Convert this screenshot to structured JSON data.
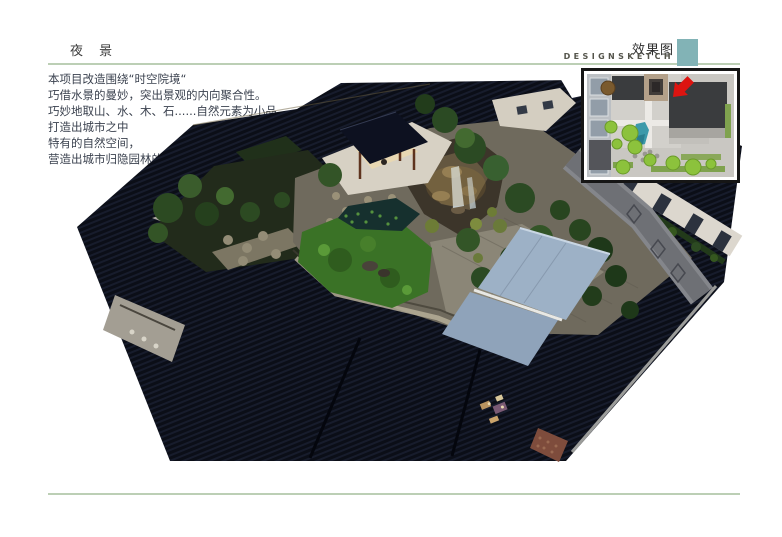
{
  "header": {
    "title": "夜 景",
    "right_title": "效果图",
    "right_subtitle": "DESIGNSKETCH"
  },
  "intro": {
    "lines": [
      "本项目改造围绕“时空院境“",
      "巧借水景的曼妙，突出景观的内向聚合性。",
      "巧妙地取山、水、木、石......自然元素为小品，",
      "打造出城市之中",
      "特有的自然空间，",
      "营造出城市归隐园林的梦境氛围。"
    ]
  },
  "icons": {
    "teal_square_icon": "teal-accent-square",
    "arrow_icon": "red-arrow-pointer"
  },
  "colors": {
    "accent_teal": "#82b3b6",
    "rule_green": "#bccfb5",
    "title_text": "#3c3c3c",
    "body_text": "#3b424f",
    "arrow_red": "#dd1410",
    "roof_dark": "#0b0e17",
    "lawn_green": "#3a7226",
    "canopy_blue": "#9db1c6",
    "wall_light": "#dcd7ce",
    "plan_building_dark": "#3a3c3e",
    "plan_tree_green": "#8cc23c",
    "plan_pool_teal": "#3d9aaa"
  }
}
